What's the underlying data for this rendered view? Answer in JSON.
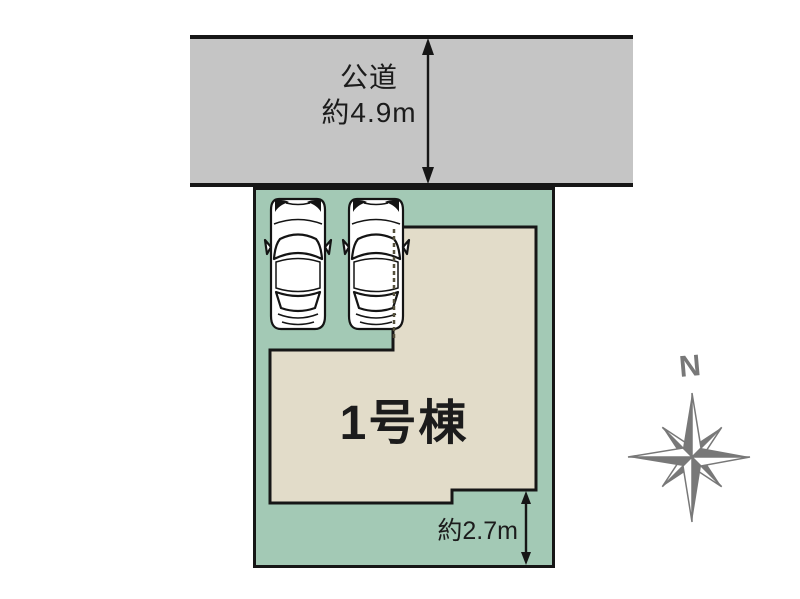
{
  "site_plan": {
    "road": {
      "name_label": "公道",
      "width_label": "約4.9m"
    },
    "building": {
      "label": "1号棟"
    },
    "setback": {
      "label": "約2.7m"
    },
    "parking": {
      "car_count": 2
    },
    "compass": {
      "north_label": "N"
    },
    "colors": {
      "road_fill": "#c5c5c5",
      "plot_fill": "#a3c9b5",
      "building_fill": "#e2dcc9",
      "outline": "#161616",
      "compass": "#787878",
      "text": "#1c1c1c"
    }
  }
}
